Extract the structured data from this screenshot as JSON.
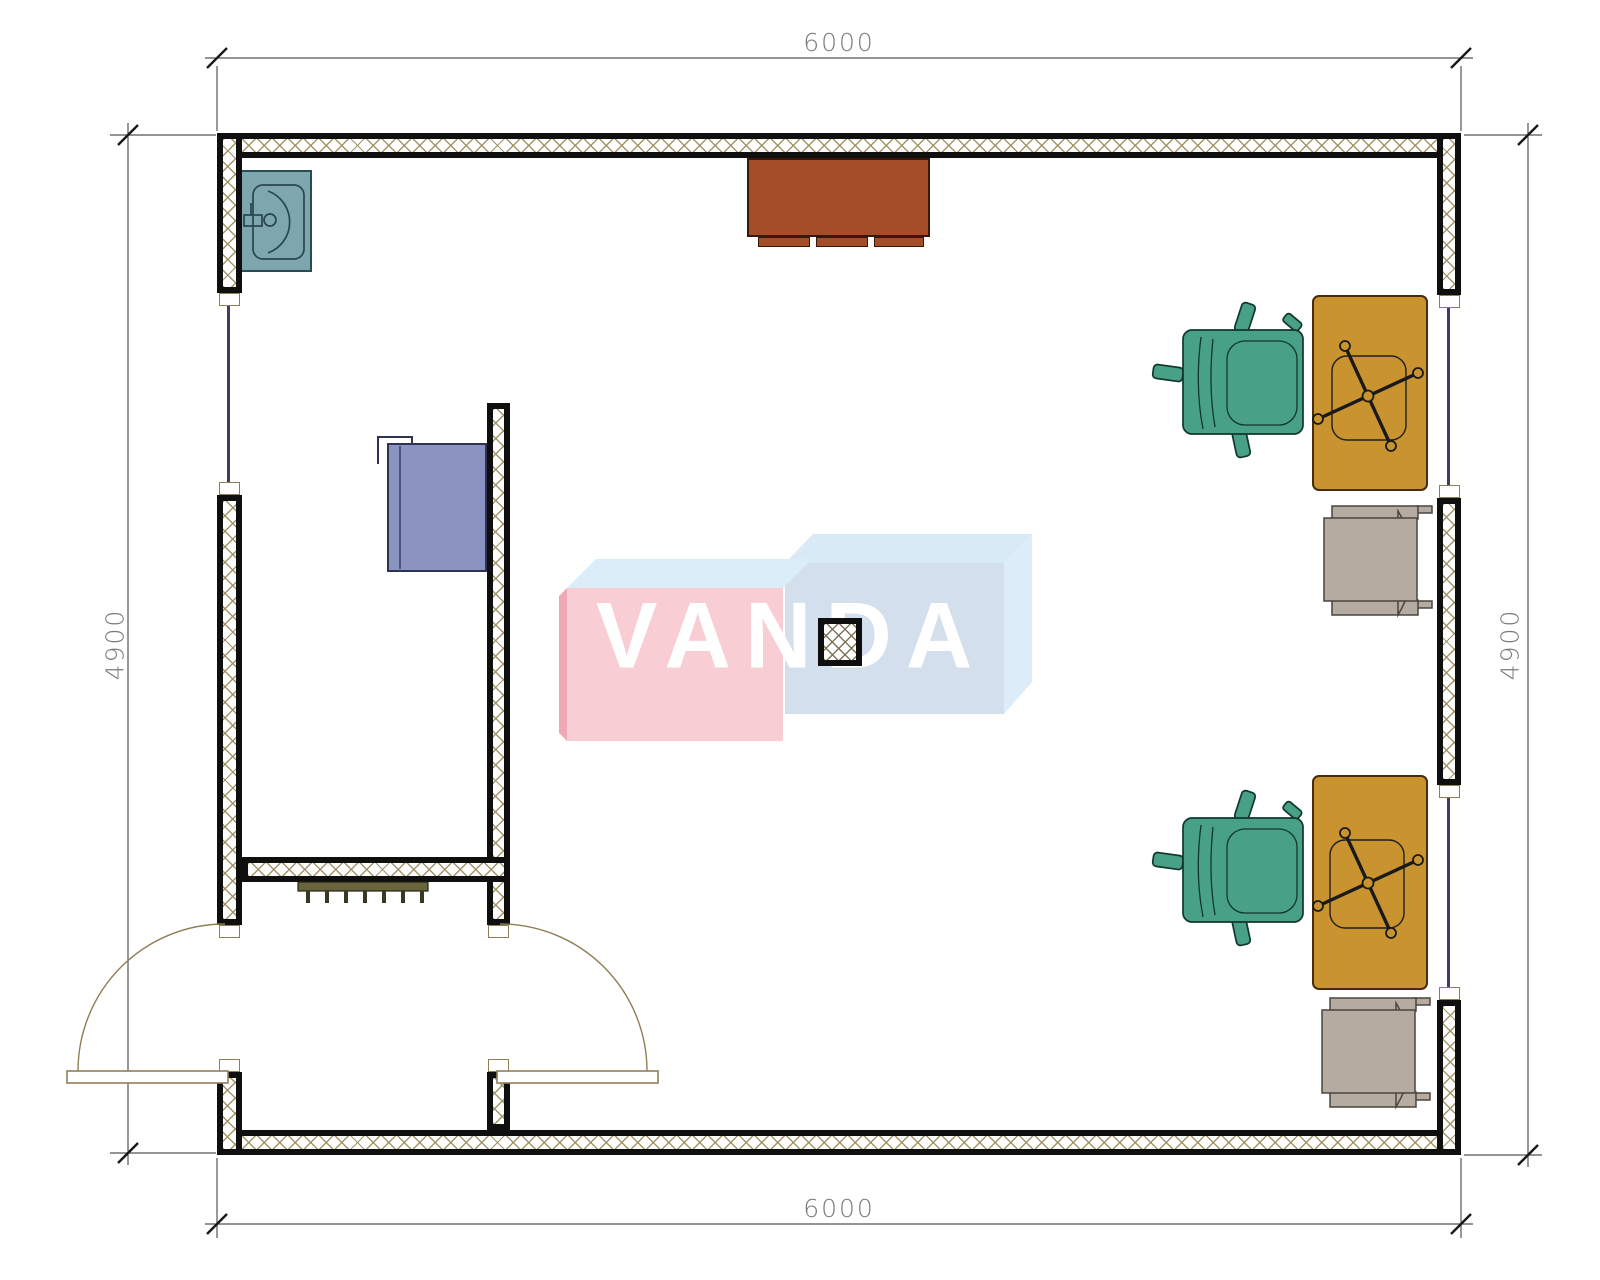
{
  "drawing": {
    "kind": "architectural floor plan, top view, hatched walls"
  },
  "dimensions": {
    "top": "6000",
    "bottom": "6000",
    "left": "4900",
    "right": "4900"
  },
  "watermark": {
    "text": "VANDA",
    "box_left_front": "#f9cdd4",
    "box_left_top": "#daedf8",
    "box_left_side": "#eea9b5",
    "box_right_front": "#d3dfec",
    "box_right_top": "#d9eaf7",
    "box_right_side": "#dcecf8",
    "letter_color": "#ffffff"
  },
  "colors": {
    "wall_line": "#0f0f0f",
    "wall_hatch": "#9e9062",
    "window_line": "#3c3c66",
    "door_arc": "#8f7f55",
    "dimension_text": "#7a7a7a",
    "sink": "#7ea6ae",
    "sideboard_table": "#a34e28",
    "cabinet": "#8b94c1",
    "desk": "#c9942f",
    "office_chair_green": "#48a186",
    "armchair_gray": "#b5aba0",
    "radiator": "#6a643e"
  },
  "objects": [
    "sink",
    "sideboard-table",
    "storage-cabinet",
    "radiator",
    "entrance-door-left",
    "entrance-door-right",
    "window-left",
    "window-right-upper",
    "window-right-lower",
    "desk-upper",
    "desk-lower",
    "office-chair-upper",
    "office-chair-lower",
    "armchair-upper",
    "armchair-lower",
    "structural-column"
  ]
}
